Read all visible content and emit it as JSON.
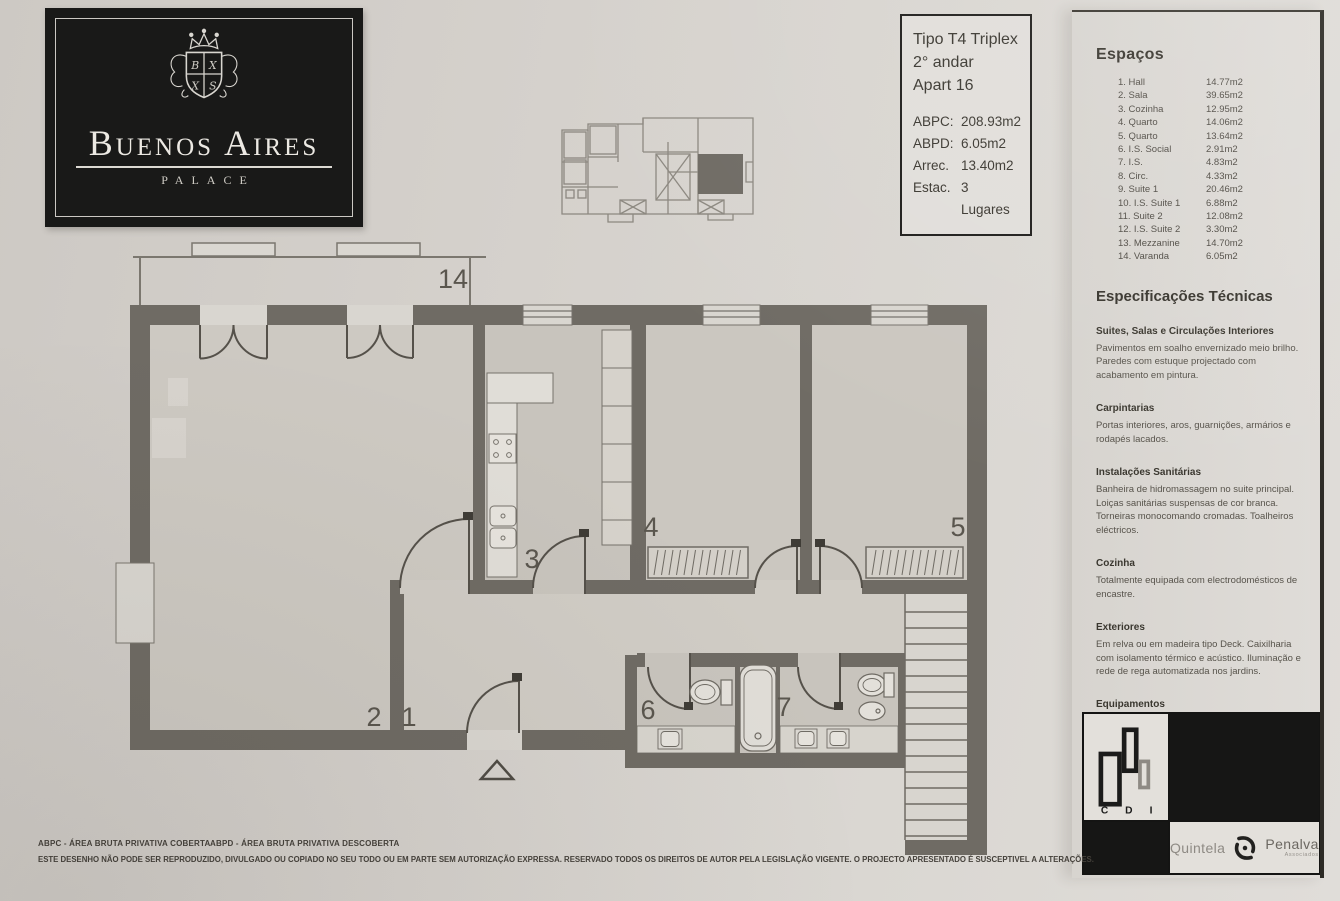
{
  "logo": {
    "title": "Buenos Aires",
    "subtitle": "PALACE",
    "crest_letters": [
      "B",
      "X",
      "X",
      "S"
    ]
  },
  "info_box": {
    "type": "Tipo T4 Triplex",
    "floor": "2° andar",
    "apartment": "Apart 16",
    "rows": [
      {
        "label": "ABPC:",
        "value": "208.93m2"
      },
      {
        "label": "ABPD:",
        "value": "6.05m2"
      },
      {
        "label": "Arrec.",
        "value": "13.40m2"
      },
      {
        "label": "Estac.",
        "value": "3 Lugares"
      }
    ]
  },
  "plan": {
    "room_numbers": [
      "1",
      "2",
      "3",
      "4",
      "5",
      "6",
      "7",
      "14"
    ]
  },
  "right_panel": {
    "spaces_title": "Espaços",
    "spaces": [
      {
        "label": "1. Hall",
        "area": "14.77m2"
      },
      {
        "label": "2. Sala",
        "area": "39.65m2"
      },
      {
        "label": "3. Cozinha",
        "area": "12.95m2"
      },
      {
        "label": "4. Quarto",
        "area": "14.06m2"
      },
      {
        "label": "5. Quarto",
        "area": "13.64m2"
      },
      {
        "label": "6. I.S. Social",
        "area": "2.91m2"
      },
      {
        "label": "7. I.S.",
        "area": "4.83m2"
      },
      {
        "label": "8. Circ.",
        "area": "4.33m2"
      },
      {
        "label": "9. Suite 1",
        "area": "20.46m2"
      },
      {
        "label": "10. I.S. Suite 1",
        "area": "6.88m2"
      },
      {
        "label": "11. Suite 2",
        "area": "12.08m2"
      },
      {
        "label": "12. I.S. Suite 2",
        "area": "3.30m2"
      },
      {
        "label": "13. Mezzanine",
        "area": "14.70m2"
      },
      {
        "label": "14. Varanda",
        "area": "6.05m2"
      }
    ],
    "specs_title": "Especificações Técnicas",
    "sections": [
      {
        "title": "Suites, Salas e Circulações Interiores",
        "body": "Pavimentos em soalho envernizado meio brilho. Paredes com estuque projectado com acabamento em pintura."
      },
      {
        "title": "Carpintarias",
        "body": "Portas interiores, aros, guarnições, armários e rodapés lacados."
      },
      {
        "title": "Instalações Sanitárias",
        "body": "Banheira de hidromassagem no suite principal. Loiças sanitárias suspensas de cor branca. Torneiras monocomando cromadas. Toalheiros eléctricos."
      },
      {
        "title": "Cozinha",
        "body": "Totalmente equipada com electrodomésticos de encastre."
      },
      {
        "title": "Exteriores",
        "body": "Em relva ou em madeira tipo Deck. Caixilharia com isolamento térmico e acústico. Iluminação e rede de rega automatizada nos jardins."
      },
      {
        "title": "Equipamentos",
        "body": "Sistema Integrado Segurança, Domótica e Video porteiro. Sistema de climatização através bomba calor com grelhas de distribuição nas paredes e tectos."
      }
    ]
  },
  "brand": {
    "cdi_letters": [
      "C",
      "D",
      "I"
    ],
    "agency": {
      "left": "Quintela",
      "right": "Penalva",
      "sub": "Associados"
    }
  },
  "footer": {
    "abpc_def": "ABPC - ÁREA BRUTA PRIVATIVA COBERTA",
    "abpd_def": "ABPD - ÁREA BRUTA PRIVATIVA DESCOBERTA",
    "disclaimer": "ESTE DESENHO NÃO PODE SER REPRODUZIDO, DIVULGADO OU COPIADO NO SEU TODO OU EM PARTE SEM AUTORIZAÇÃO EXPRESSA. RESERVADO TODOS OS DIREITOS DE AUTOR PELA LEGISLAÇÃO VIGENTE. O PROJECTO APRESENTADO É SUSCEPTIVEL A ALTERAÇÕES."
  },
  "colors": {
    "paper": "#d6d2cd",
    "wall": "#6f6b64",
    "ink": "#3c3832",
    "logo_bg": "#191918"
  }
}
